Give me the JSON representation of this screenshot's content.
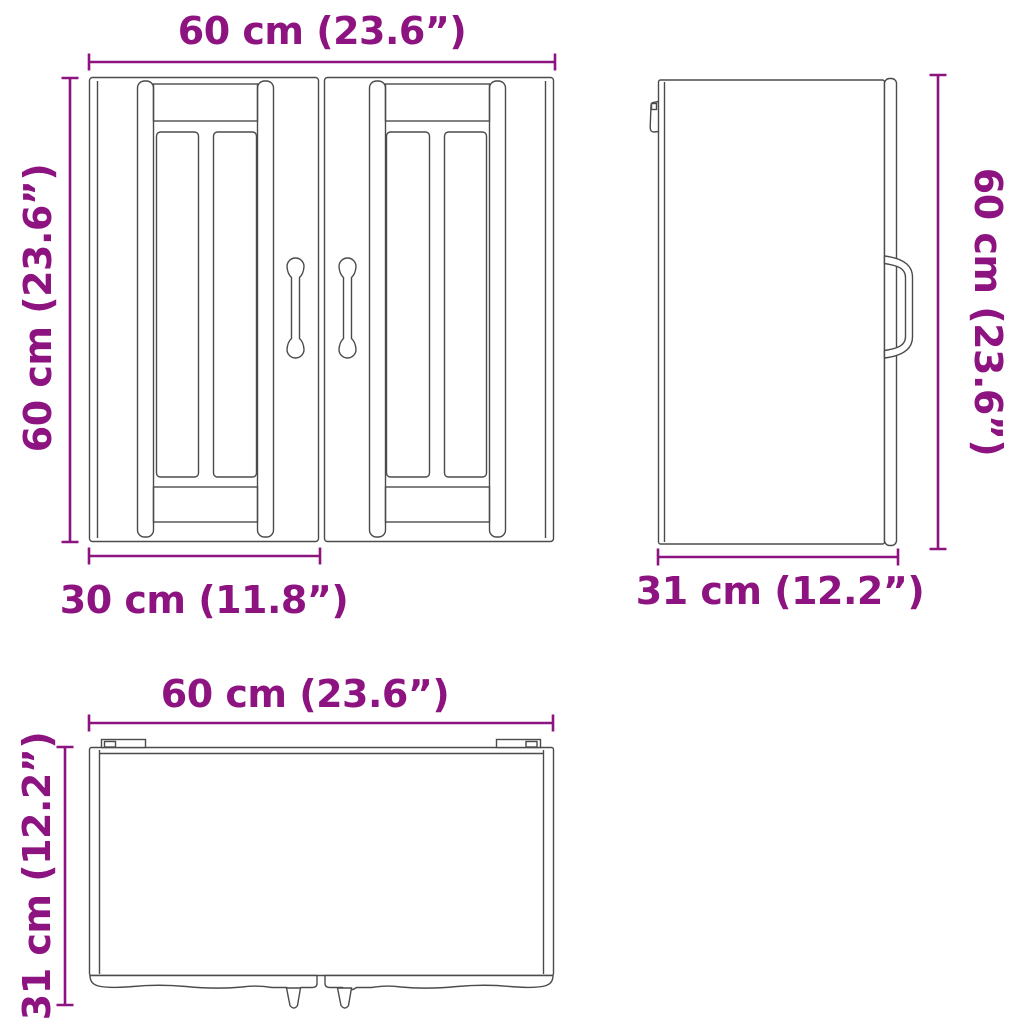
{
  "diagram_title": "Wall cabinet dimension diagram (three orthographic views)",
  "colors": {
    "dimension_accent": "#8d1480",
    "drawing_line": "#4b4b4b",
    "background": "#ffffff"
  },
  "views": {
    "front": {
      "name": "front view",
      "width_label": "60 cm (23.6”)",
      "height_label": "60 cm (23.6”)",
      "door_width_label": "30 cm (11.8”)"
    },
    "side": {
      "name": "side view",
      "height_label": "60 cm (23.6”)",
      "depth_label": "31 cm (12.2”)"
    },
    "top": {
      "name": "top view",
      "width_label": "60 cm (23.6”)",
      "depth_label": "31 cm (12.2”)"
    }
  }
}
